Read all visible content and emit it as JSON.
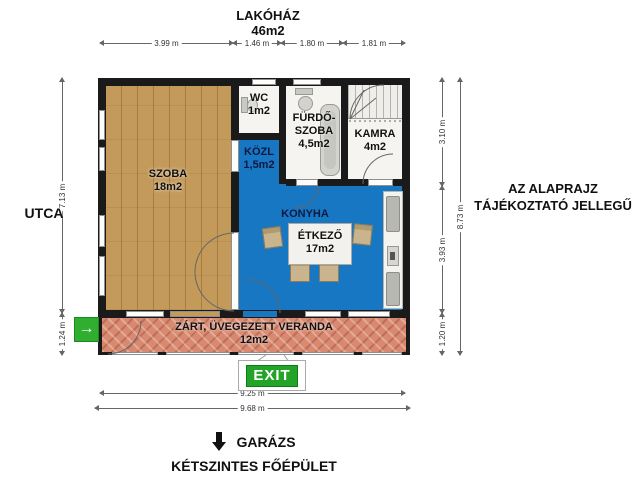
{
  "title": {
    "name": "LAKÓHÁZ",
    "area": "46m2"
  },
  "street_label": "UTCA",
  "disclaimer": {
    "line1": "AZ ALAPRAJZ",
    "line2": "TÁJÉKOZTATÓ JELLEGŰ"
  },
  "rooms": {
    "szoba": {
      "name": "SZOBA",
      "area": "18m2"
    },
    "wc": {
      "name": "WC",
      "area": "1m2"
    },
    "furdoszoba": {
      "name_line1": "FÜRDŐ-",
      "name_line2": "SZOBA",
      "area": "4,5m2"
    },
    "kamra": {
      "name": "KAMRA",
      "area": "4m2"
    },
    "kozlekedo": {
      "name": "KÖZL",
      "area": "1,5m2"
    },
    "konyha": {
      "name_line1": "KONYHA",
      "name_line2": "ÉTKEZŐ",
      "area": "17m2"
    },
    "veranda": {
      "name": "ZÁRT, ÜVEGEZETT VERANDA",
      "area": "12m2"
    }
  },
  "dimensions": {
    "top": [
      "3.99 m",
      "1.46 m",
      "1.80 m",
      "1.81 m"
    ],
    "left": [
      "7.13 m",
      "1.24 m"
    ],
    "right_inner": [
      "3.10 m",
      "3.93 m",
      "1.20 m"
    ],
    "right_outer": "8.73 m",
    "bottom": [
      "9.25 m",
      "9.68 m"
    ]
  },
  "exit_label": "EXIT",
  "footer": {
    "garage": "GARÁZS",
    "main_building": "KÉTSZINTES FŐÉPÜLET"
  },
  "icons": {
    "entrance_arrow": "green-right-arrow",
    "garage_arrow": "black-down-arrow"
  },
  "colors": {
    "wall": "#1a1a1a",
    "wood_floor": "#c49a5a",
    "kitchen_floor": "#1877c2",
    "white_floor": "#f5f4f0",
    "veranda_floor": "#d9896f",
    "exit_green": "#23a428",
    "entrance_green": "#2fae2f"
  }
}
